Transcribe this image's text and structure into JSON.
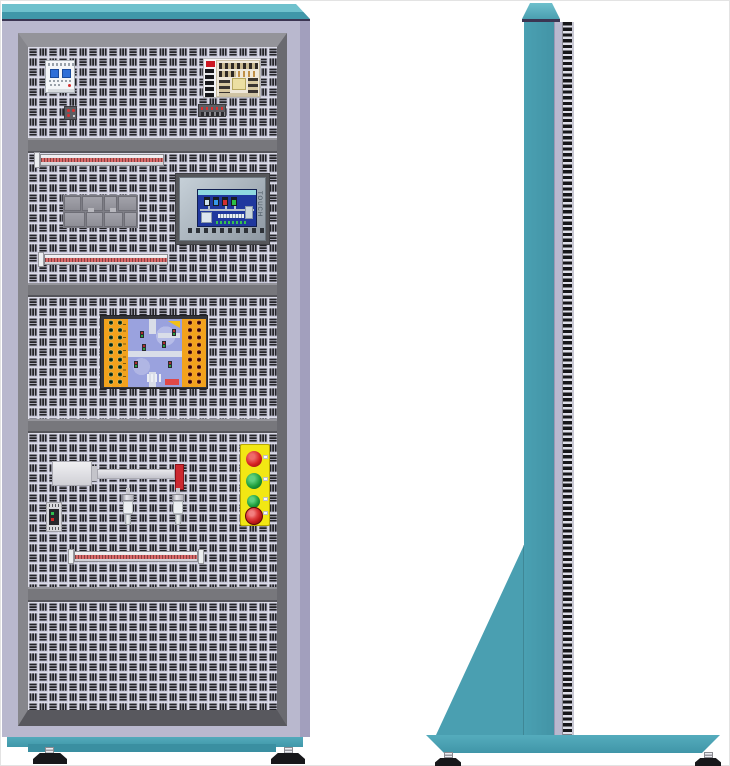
{
  "hmi": {
    "side_text": "TOUCH"
  },
  "front_view": {
    "components": [
      "circuit-breaker",
      "switching-power-supply",
      "din-terminal-block",
      "din-terminal-block",
      "terminal-strip",
      "relay-module-group",
      "hmi-touch-panel",
      "terminal-strip",
      "io-training-board",
      "linear-actuator",
      "proximity-sensor",
      "proximity-sensor",
      "sensor-module",
      "push-button-station",
      "terminal-strip"
    ],
    "push_button_station": {
      "buttons": [
        "red",
        "green",
        "green",
        "emergency-stop"
      ],
      "button_count": 4
    },
    "panel_count": 5
  },
  "side_view": {
    "components": [
      "top-cap",
      "column",
      "mounting-rail-slots",
      "support-gusset",
      "base-plate",
      "leveling-foot",
      "leveling-foot"
    ]
  },
  "colors": {
    "teal_light": "#6fc1cd",
    "teal": "#4097a9",
    "teal_side": "#4a9fb1",
    "cap_line": "#3b3552",
    "lavender": "#b9b8ce",
    "lavender_shade": "#a29fbd",
    "frame_gray": "#77777c",
    "panel_bg": "#cacadb",
    "slot_dark": "#232327",
    "strip_red": "#d96a6a",
    "hmi_screen_blue": "#20389e",
    "hmi_header_cyan": "#8fd8e0",
    "board_orange": "#f2a21c",
    "socket_green": "#1a4a2c",
    "socket_red": "#5a1414",
    "pcb_violet": "#9aa2de",
    "station_yellow": "#f2e714",
    "button_red": "#d62222",
    "button_green": "#1f9e3c",
    "estop_red": "#c41c1c",
    "actuator_red": "#cc2830",
    "foot_black": "#17171a",
    "breaker_blue": "#2f6fd8",
    "psu_red": "#cc1822"
  }
}
